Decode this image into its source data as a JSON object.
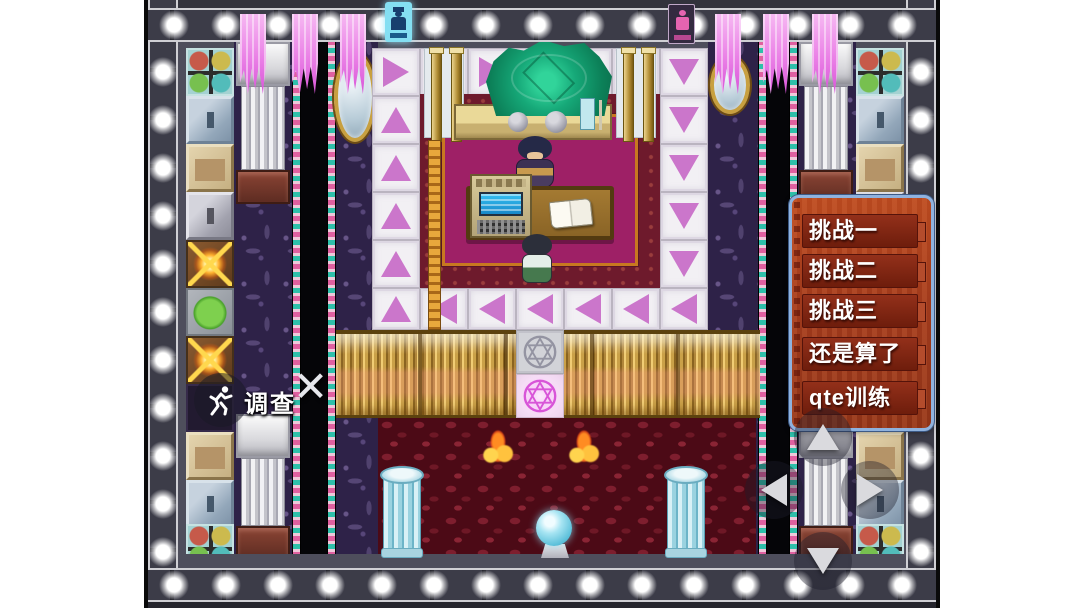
{
  "menu": {
    "items": [
      {
        "label": "挑战一"
      },
      {
        "label": "挑战二"
      },
      {
        "label": "挑战三"
      },
      {
        "label": "还是算了"
      },
      {
        "label": "qte训练"
      }
    ]
  },
  "hud": {
    "investigate_label": "调查",
    "close_glyph": "✕"
  },
  "icons": {
    "run_skill": "runner-icon",
    "close": "close-x-icon",
    "dpad": [
      "dpad-up-icon",
      "dpad-left-icon",
      "dpad-right-icon",
      "dpad-down-icon"
    ],
    "gate_symbols": [
      "hexagram-circle-gray",
      "hexagram-circle-pink"
    ]
  },
  "colors": {
    "menu_border": "#8fb2de",
    "menu_background": "#a03a1c",
    "menu_item": "#7c2311",
    "arrow_tile_pink": "#cb76cb",
    "carpet_magenta": "#9e2066",
    "carpet_border_crimson": "#6e1a2c",
    "floor_red": "#4c0a16",
    "fence_gold": "#caa148",
    "crystal_green": "#16a878",
    "pillar_cyan": "#8cc8d8",
    "banner_pink": "#ea80e6",
    "light_strip": "#2f2f3a"
  }
}
